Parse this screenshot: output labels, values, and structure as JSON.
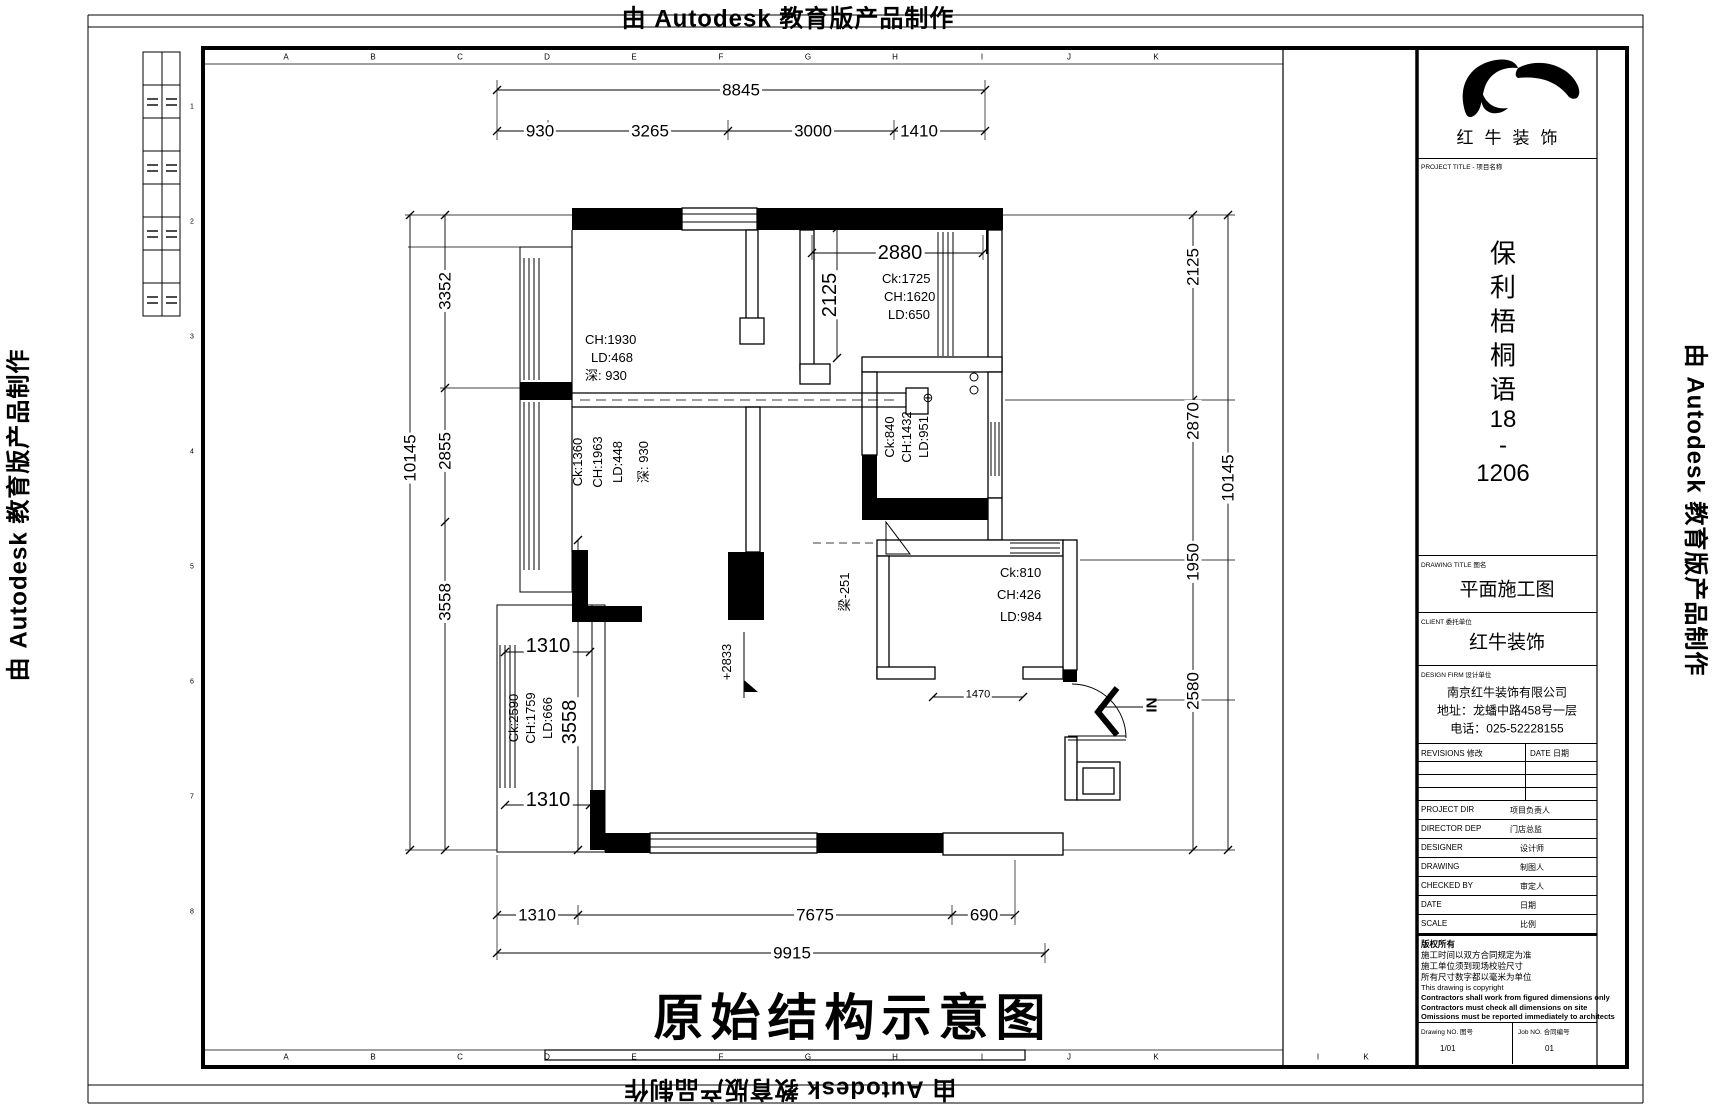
{
  "watermark": {
    "text": "由 Autodesk 教育版产品制作"
  },
  "frame": {
    "grid_letters": [
      "A",
      "B",
      "C",
      "D",
      "E",
      "F",
      "G",
      "H",
      "I",
      "J",
      "K"
    ],
    "grid_letters_extra": [
      "I",
      "K"
    ],
    "row_numbers": [
      "1",
      "2",
      "3",
      "4",
      "5",
      "6",
      "7",
      "8"
    ]
  },
  "title_block": {
    "brand": "红牛装饰",
    "project_label": "PROJECT TITLE - 项目名称",
    "project_name_chars": [
      "保",
      "利",
      "梧",
      "桐",
      "语",
      "18",
      "-",
      "1206"
    ],
    "drawing_title_label": "DRAWING TITLE 图名",
    "drawing_title": "平面施工图",
    "client_label": "CLIENT 委托单位",
    "client": "红牛装饰",
    "design_firm_label": "DESIGN FIRM 设计单位",
    "design_firm_lines": [
      "南京红牛装饰有限公司",
      "地址：龙蟠中路458号一层",
      "电话：025-52228155"
    ],
    "revisions_label": "REVISIONS 修改",
    "date_label": "DATE 日期",
    "fields": [
      {
        "label": "PROJECT DIR",
        "cn": "项目负责人"
      },
      {
        "label": "DIRECTOR DEP",
        "cn": "门店总监"
      },
      {
        "label": "DESIGNER",
        "cn": "设计师"
      },
      {
        "label": "DRAWING",
        "cn": "制图人"
      },
      {
        "label": "CHECKED BY",
        "cn": "审定人"
      },
      {
        "label": "DATE",
        "cn": "日期"
      },
      {
        "label": "SCALE",
        "cn": "比例"
      }
    ],
    "notes": [
      "版权所有",
      "施工时间以双方合同规定为准",
      "施工单位须到现场校验尺寸",
      "所有尺寸数字都以毫米为单位",
      "This drawing is copyright",
      "Contractors shall work from figured dimensions only",
      "Contractors must check all dimensions on site",
      "Omissions must be reported immediately to architects"
    ],
    "drawing_no_label": "Drawing NO. 图号",
    "drawing_no": "1/01",
    "job_no_label": "Job NO. 合同编号",
    "job_no": "01"
  },
  "plan": {
    "main_title": "原始结构示意图",
    "dims": {
      "top_total": "8845",
      "top_segments": [
        "930",
        "3265",
        "3000",
        "1410"
      ],
      "left_total": "10145",
      "left_segments": [
        "3352",
        "2855",
        "3558"
      ],
      "right_total": "10145",
      "right_segments": [
        "2125",
        "2870",
        "1950",
        "2580"
      ],
      "bottom_segments": [
        "1310",
        "7675",
        "690"
      ],
      "bottom_total": "9915",
      "kitchen_width": "2880",
      "kitchen_height": "2125",
      "hall": "1470",
      "balcony_top": "1310",
      "balcony_bottom": "1310",
      "balcony_height": "3558"
    },
    "labels": {
      "room1": [
        "CH:1930",
        "LD:468",
        "深: 930"
      ],
      "room2": [
        "Ck:1360",
        "CH:1963",
        "LD:448",
        "深: 930"
      ],
      "kitchen": [
        "Ck:1725",
        "CH:1620",
        "LD:650"
      ],
      "bath": [
        "Ck:840",
        "CH:1432",
        "LD:951"
      ],
      "bath_symbol": "⊕",
      "room3": [
        "Ck:810",
        "CH:426",
        "LD:984"
      ],
      "balcony": [
        "Ck:2590",
        "CH:1759",
        "LD:666"
      ],
      "beam": "梁-251",
      "level": "+2833",
      "entry": "IN"
    }
  }
}
